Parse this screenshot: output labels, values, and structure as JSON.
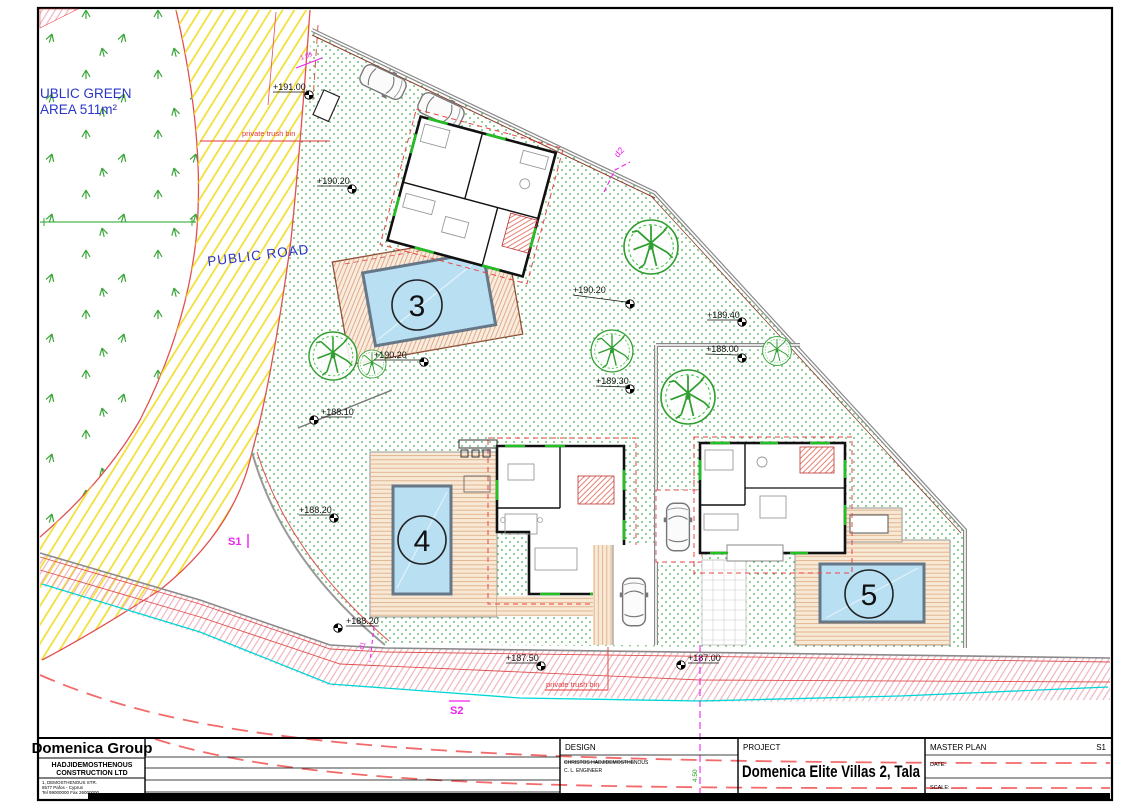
{
  "plan": {
    "green_area_line1": "UBLIC GREEN",
    "green_area_line2": "AREA 511m²",
    "public_road": "PUBLIC ROAD",
    "trash_top": "private trush bin",
    "trash_bottom": "private trush bin",
    "section_s1": "S1",
    "section_s2": "S2",
    "section_d2": "d2",
    "section_d1": "d1",
    "dim_road": "1.05",
    "dim_plot": "4.50",
    "villas": [
      {
        "number": "3"
      },
      {
        "number": "4"
      },
      {
        "number": "5"
      }
    ],
    "elevations": [
      {
        "value": "+191.00"
      },
      {
        "value": "+190.20"
      },
      {
        "value": "+190.20"
      },
      {
        "value": "+189.40"
      },
      {
        "value": "+188.00"
      },
      {
        "value": "+189.30"
      },
      {
        "value": "+190.20"
      },
      {
        "value": "+188.10"
      },
      {
        "value": "+188.20"
      },
      {
        "value": "+188.20"
      },
      {
        "value": "+187.50"
      },
      {
        "value": "+187.00"
      }
    ]
  },
  "title_block": {
    "company": "Domenica Group",
    "company_line1": "HADJIDEMOSTHENOUS",
    "company_line2": "CONSTRUCTION LTD",
    "address_line1": "1, DEMOSTHENOUS STR.",
    "address_line2": "8577 Pafos - Cyprus",
    "address_line3": "Tel 99000000  Fax 26000000",
    "design_label": "DESIGN",
    "design_line1": "CHRISTOS HADJIDEMOSTHENOUS",
    "design_line2": "C. L. ENGINEER",
    "project_label": "PROJECT",
    "project_name": "Domenica Elite Villas 2, Tala",
    "sheet_title": "MASTER PLAN",
    "sheet_no": "S1",
    "date_label": "DATE:",
    "scale_label": "SCALE:"
  },
  "colors": {
    "boundary_red": "#e05050",
    "road_yellow": "#f2de30",
    "garden_green": "#3fae4a",
    "pool_blue": "#b8dff2",
    "section_magenta": "#ee22ee",
    "contour_cyan": "#00d6d6"
  }
}
